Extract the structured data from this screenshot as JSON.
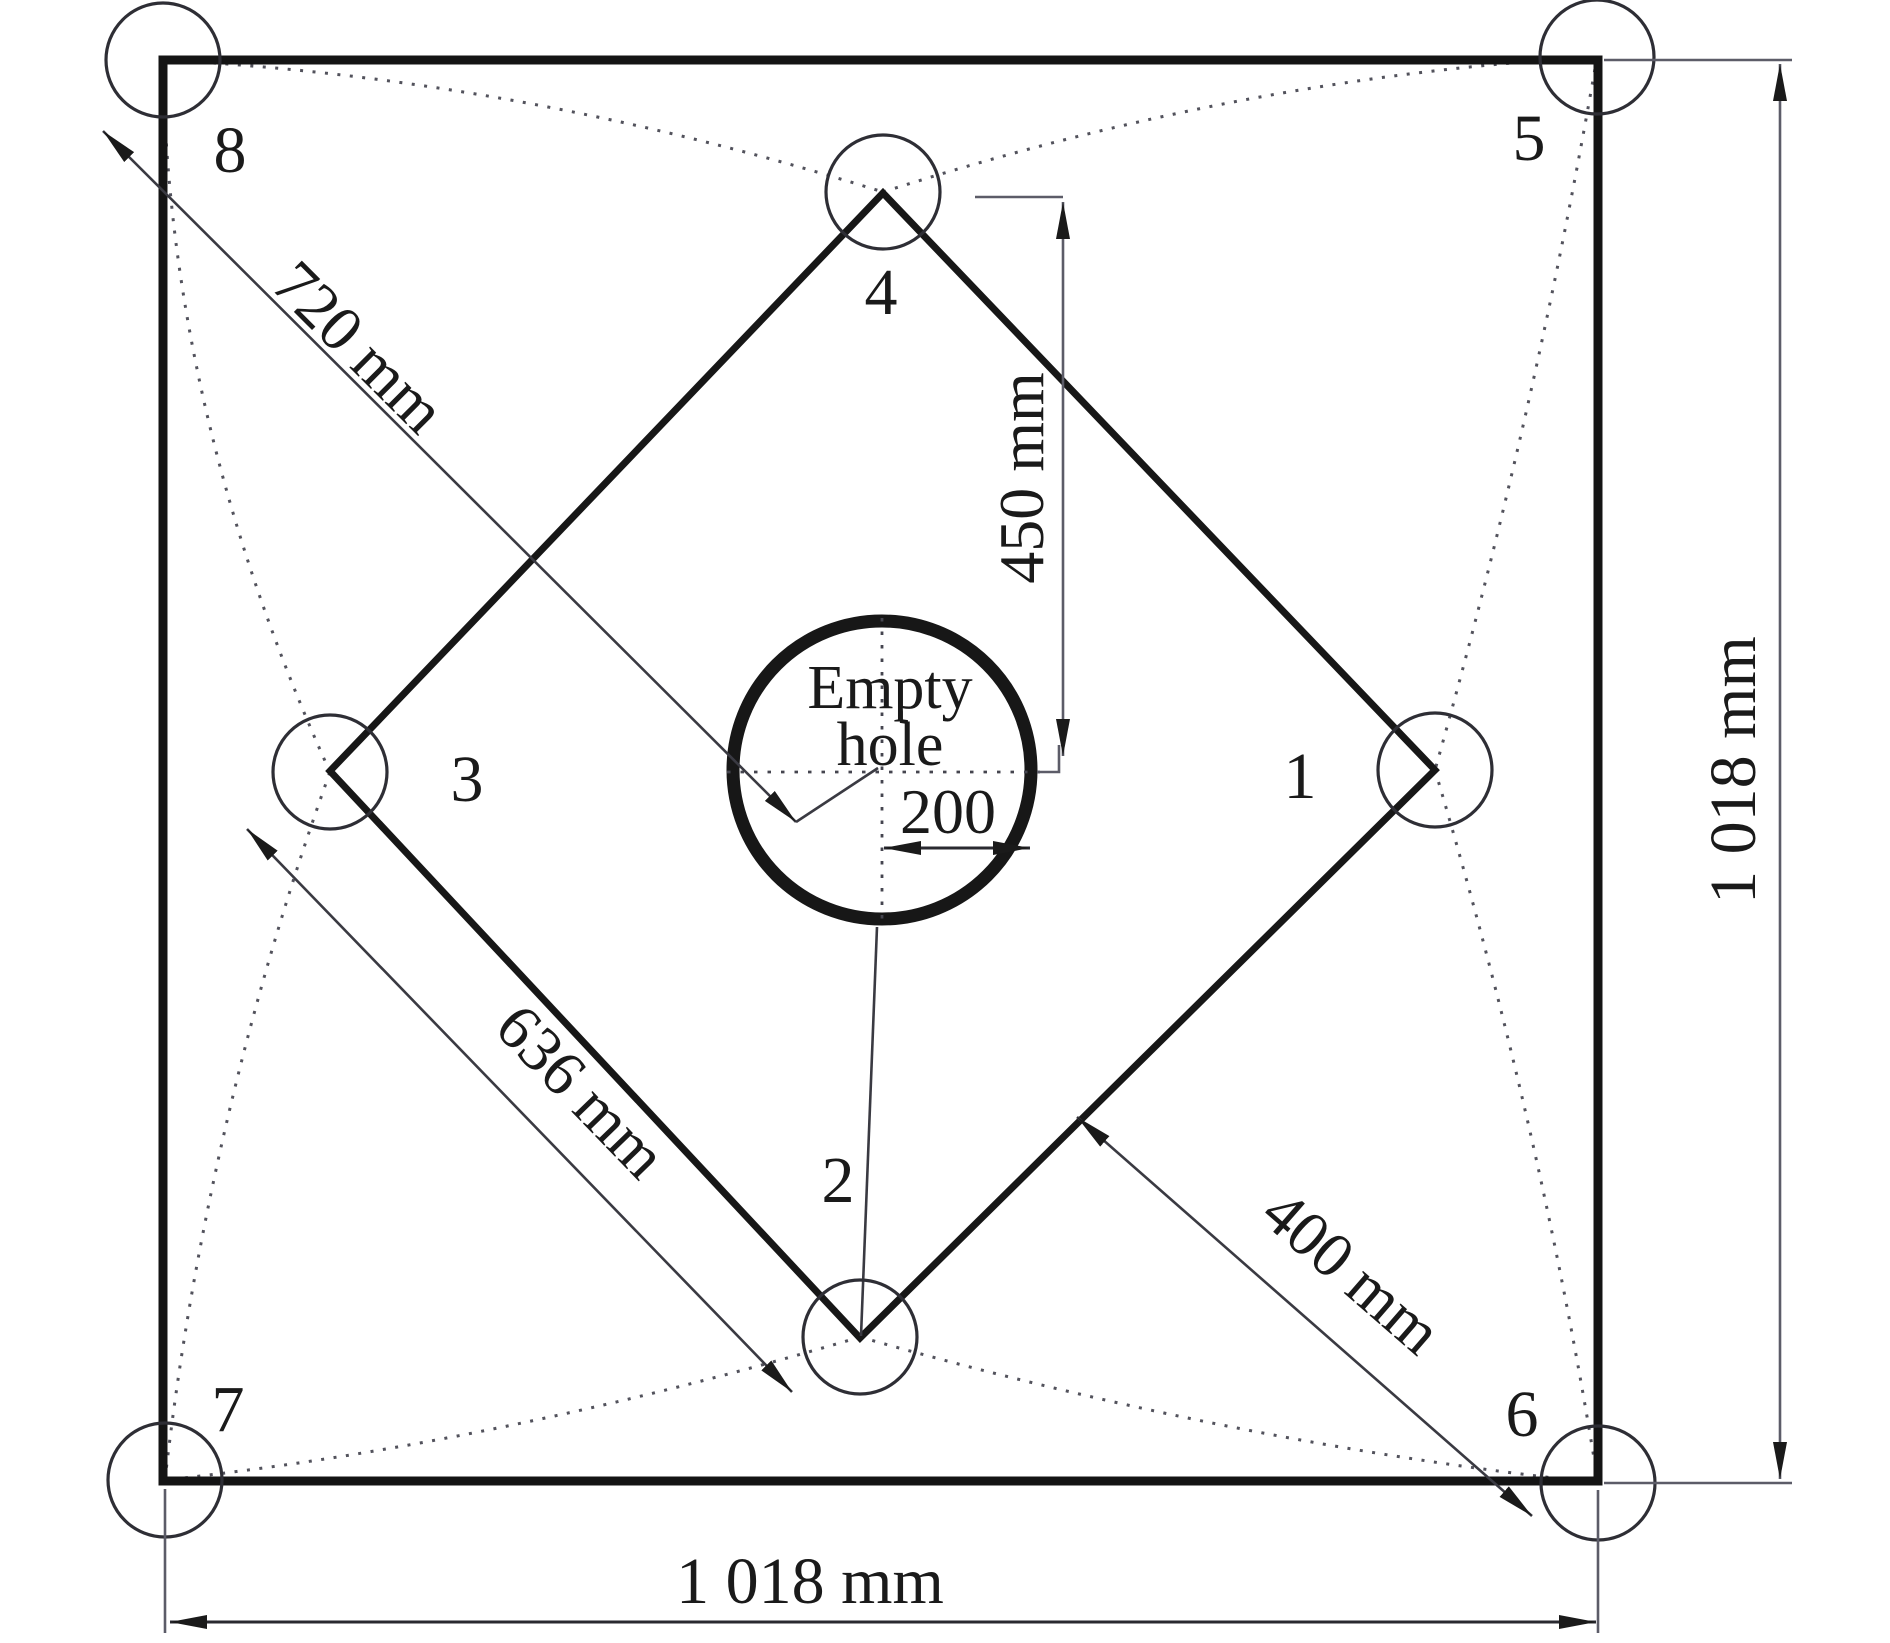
{
  "diagram": {
    "empty_hole": {
      "label_line1": "Empty",
      "label_line2": "hole"
    },
    "holes": [
      {
        "n": "1"
      },
      {
        "n": "2"
      },
      {
        "n": "3"
      },
      {
        "n": "4"
      },
      {
        "n": "5"
      },
      {
        "n": "6"
      },
      {
        "n": "7"
      },
      {
        "n": "8"
      }
    ],
    "dims": {
      "d200": "200",
      "d450": "450 mm",
      "d720": "720 mm",
      "d636": "636 mm",
      "d400": "400 mm",
      "width": "1 018 mm",
      "height": "1 018 mm"
    },
    "colors": {
      "ink": "#1a1a1a",
      "dim_line": "#5c5c68",
      "dotted": "#52525c"
    }
  }
}
